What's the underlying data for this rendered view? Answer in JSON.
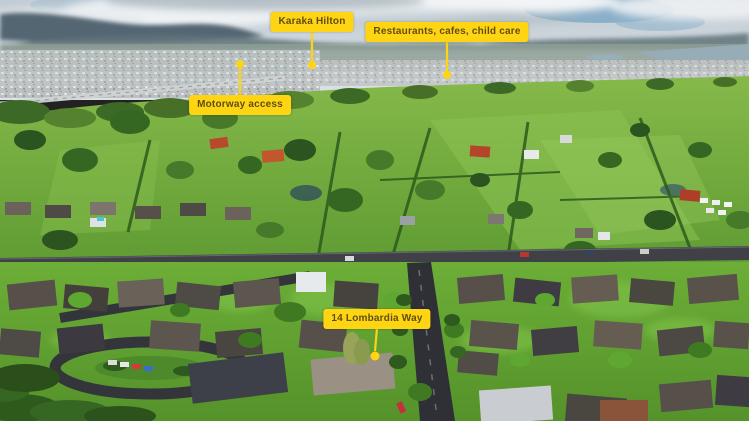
{
  "meta": {
    "type": "annotated aerial photograph",
    "scene": "Aerial drone view over a suburb: residential streets in the foreground, bright green lifestyle paddocks in the middle distance, a distant township, motorway and estuary on the horizon under a cloudy sky"
  },
  "style": {
    "annotation_background": "#FFD412",
    "annotation_text_color": "#5E4E14",
    "pointer_color": "#FFD412"
  },
  "annotations": [
    {
      "id": "karaka-hilton",
      "label": "Karaka Hilton"
    },
    {
      "id": "restaurants",
      "label": "Restaurants, cafes, child care"
    },
    {
      "id": "motorway-access",
      "label": "Motorway access"
    },
    {
      "id": "property",
      "label": "14 Lombardia Way"
    }
  ]
}
